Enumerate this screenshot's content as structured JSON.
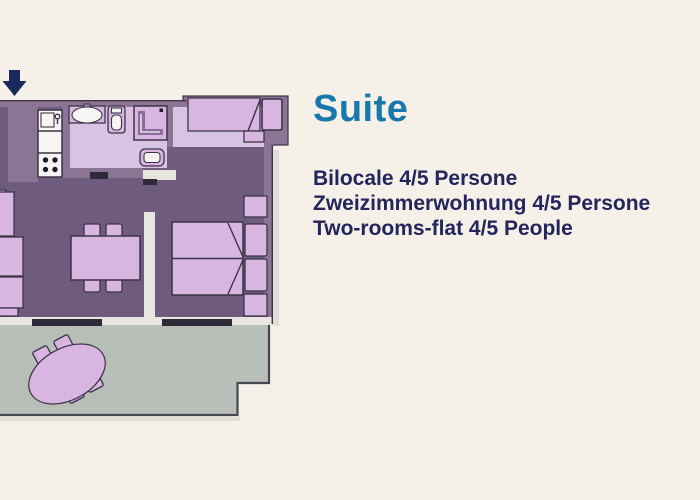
{
  "colors": {
    "background": "#f5f1e9",
    "title": "#1878ab",
    "text": "#23255c",
    "wall": "#8b7494",
    "floor": "#6f5b7e",
    "bathroom-floor": "#d8c3e2",
    "furniture": "#d9b6e2",
    "terrace": "#b8beb8",
    "terrace-outline": "#4a4552",
    "outline": "#3c3447",
    "inner-wall": "#e9e6e2",
    "door": "#2f2a3a",
    "fixture": "#f7f5f3",
    "arrow": "#1b2a5e"
  },
  "heading": {
    "title": "Suite"
  },
  "description": {
    "lines": [
      "Bilocale 4/5 Persone",
      "Zweizimmerwohnung 4/5 Persone",
      "Two-rooms-flat 4/5 People"
    ]
  },
  "floor_plan": {
    "label": "suite-floor-plan",
    "entrance_marker": "down-arrow",
    "rooms": [
      "kitchen",
      "bathroom",
      "living-dining-room",
      "bedroom",
      "sleeping-niche",
      "terrace"
    ],
    "furniture": [
      "kitchen-sink",
      "stove",
      "washbasin",
      "toilet",
      "shower",
      "bidet",
      "single-bed",
      "pillow",
      "sofa",
      "dining-table",
      "dining-chairs",
      "double-bed",
      "double-bed-pillows",
      "nightstands",
      "terrace-table",
      "terrace-chairs"
    ]
  }
}
